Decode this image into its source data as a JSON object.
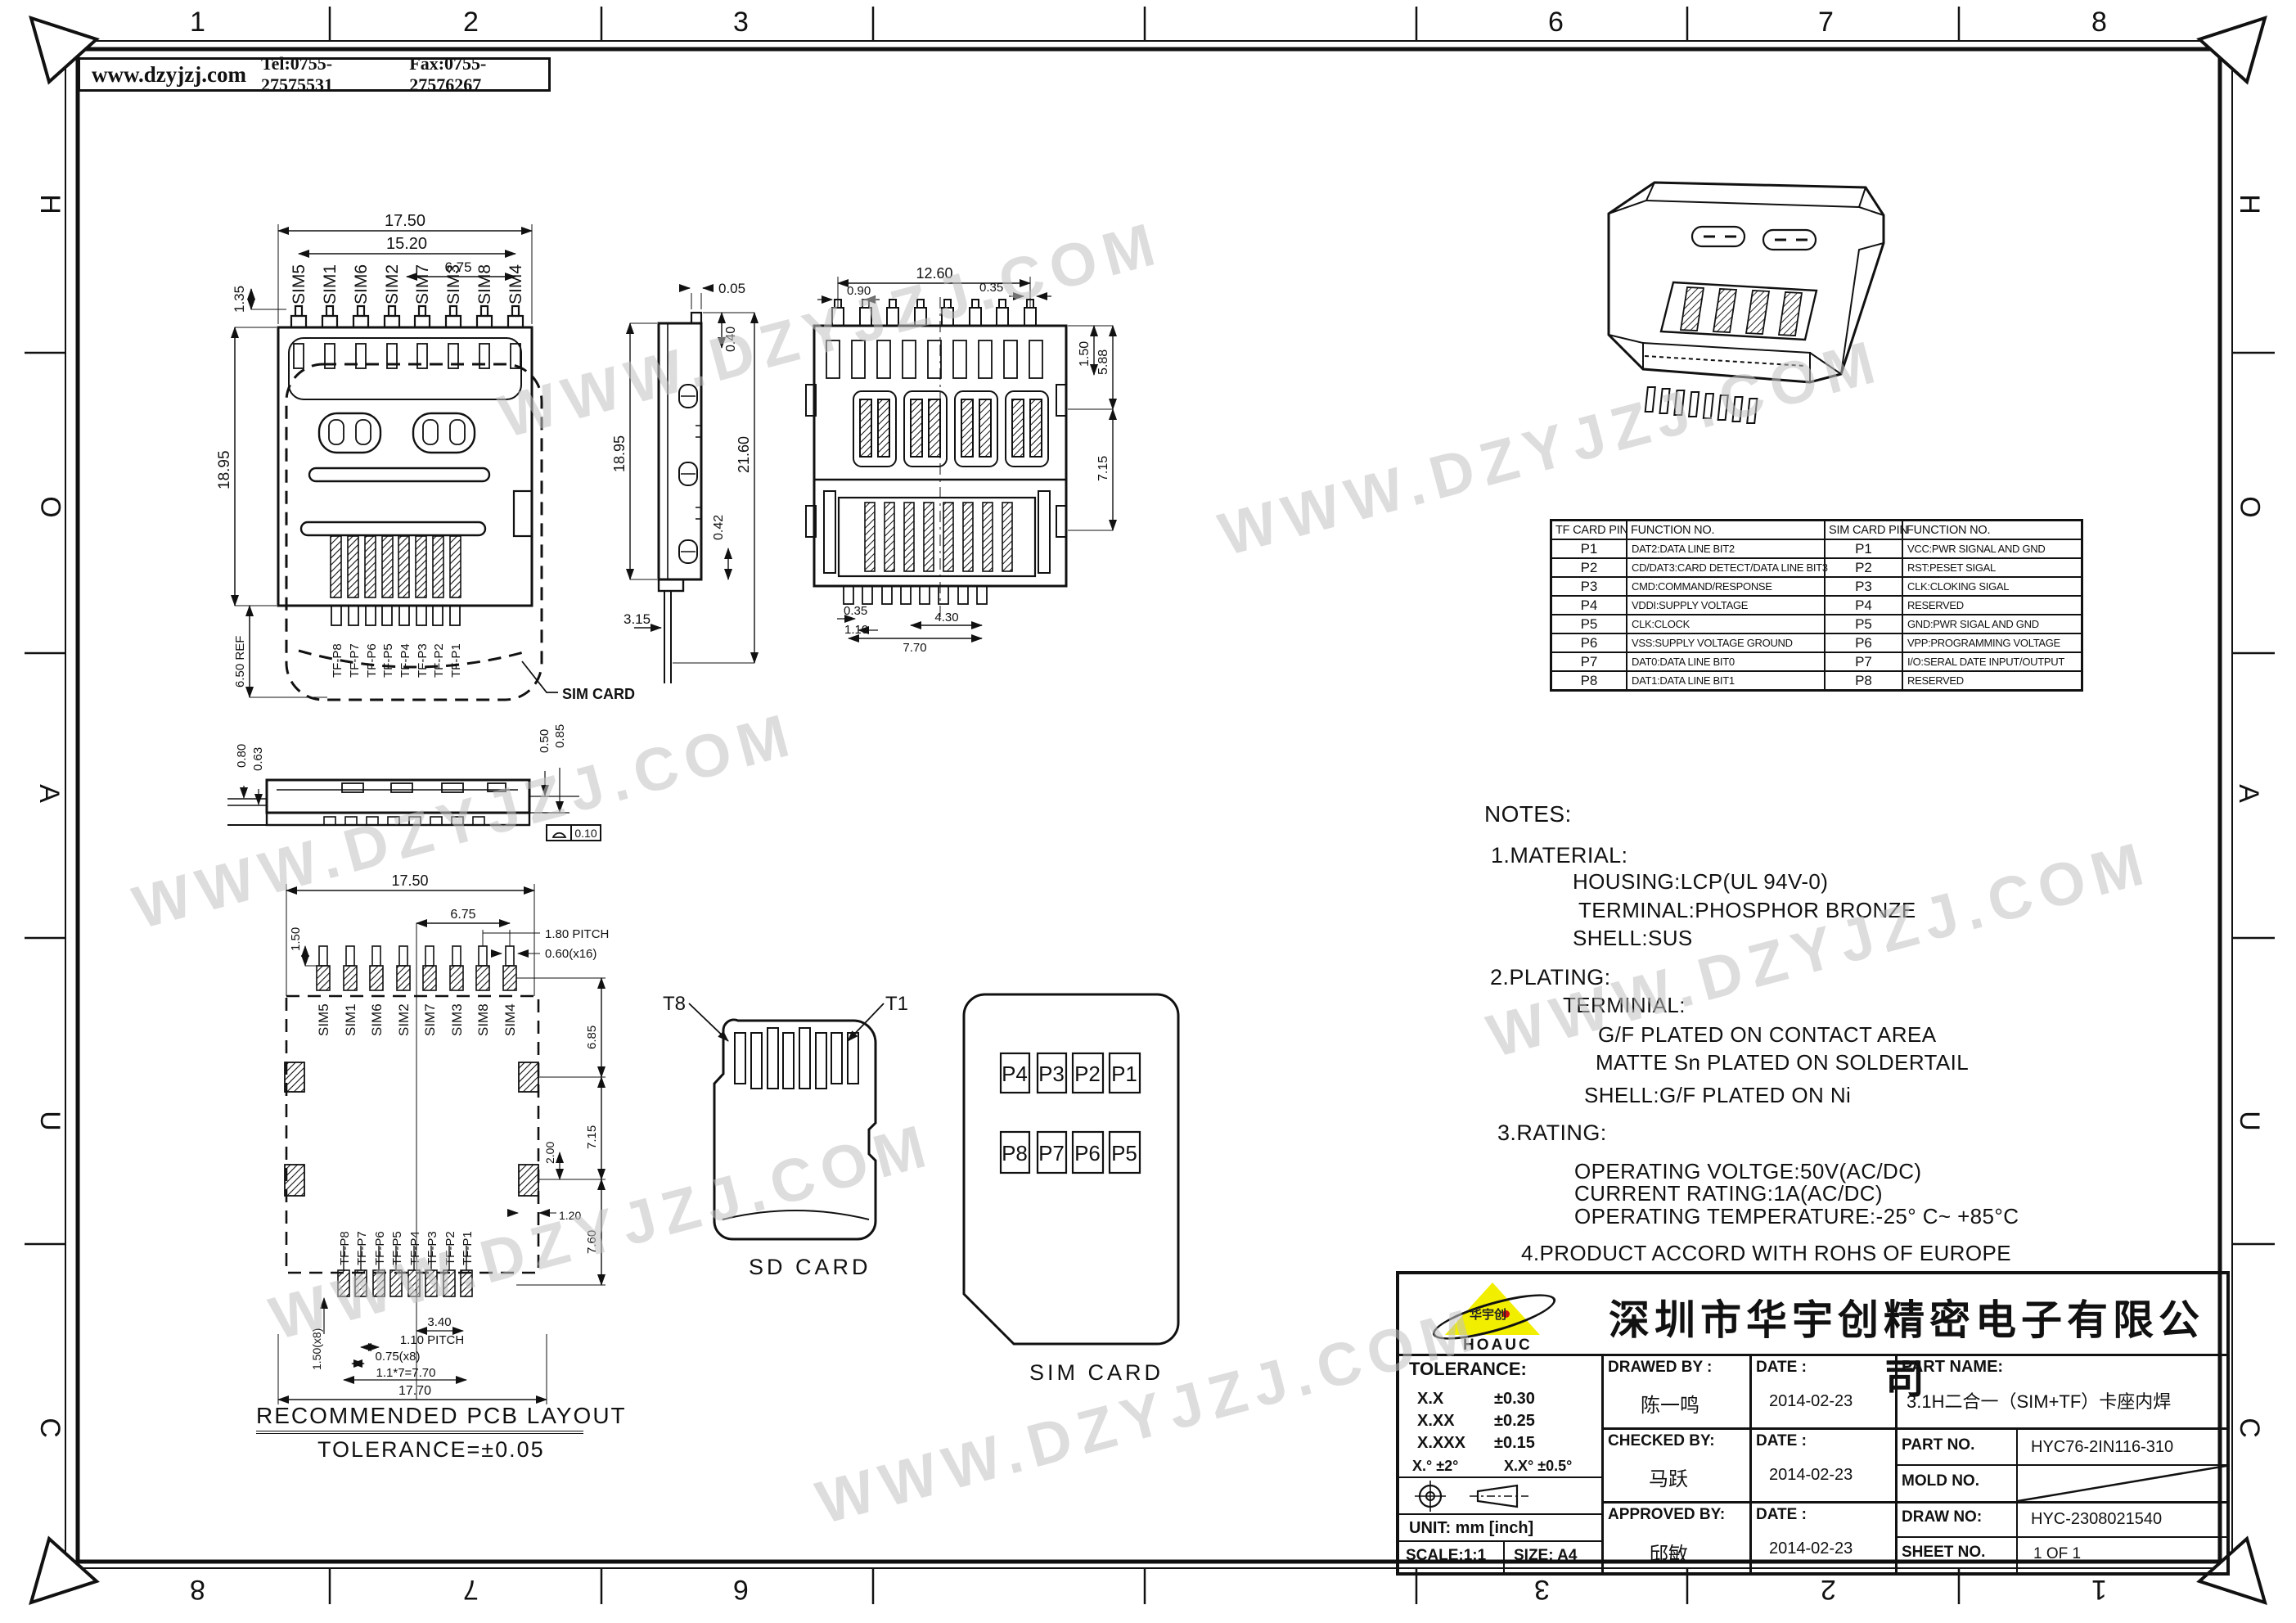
{
  "header": {
    "website": "www.dzyjzj.com",
    "tel": "Tel:0755-27575531",
    "fax": "Fax:0755-27576267"
  },
  "frame": {
    "top_numbers": [
      "1",
      "2",
      "3",
      "6",
      "7",
      "8"
    ],
    "bottom_numbers": [
      "8",
      "7",
      "6",
      "3",
      "2",
      "1"
    ],
    "left_letters": [
      "H",
      "O",
      "A",
      "U",
      "C"
    ],
    "right_letters": [
      "H",
      "O",
      "A",
      "U",
      "C"
    ]
  },
  "watermark": {
    "text": "WWW.DZYJZJ.COM",
    "color": "#c3c3c3"
  },
  "pins": {
    "sim": [
      "SIM5",
      "SIM1",
      "SIM6",
      "SIM2",
      "SIM7",
      "SIM3",
      "SIM8",
      "SIM4"
    ],
    "tf": [
      "TF-P8",
      "TF-P7",
      "TF-P6",
      "TF-P5",
      "TF-P4",
      "TF-P3",
      "TF-P2",
      "TF-P1"
    ]
  },
  "top_view": {
    "dims": {
      "w": "17.50",
      "pins_w": "15.20",
      "half_w": "6.75",
      "pin_h": "1.35",
      "h": "18.95",
      "ref": "6.50 REF"
    },
    "callout": "SIM CARD"
  },
  "side_view": {
    "dims": {
      "step": "0.05",
      "lip": "0.40",
      "h": "18.95",
      "total_h": "21.60",
      "foot": "0.42",
      "tail": "3.15"
    }
  },
  "front_view": {
    "dims": {
      "w": "12.60",
      "off": "0.90",
      "pin_w": "0.35",
      "lip": "1.50",
      "upper": "5.88",
      "lower": "7.15",
      "bpin": "0.35",
      "bpitch": "1.10",
      "bspan": "4.30",
      "btotal": "7.70"
    }
  },
  "profile_view": {
    "dims": {
      "h1": "0.80",
      "h2": "0.63",
      "h3": "0.50",
      "h4": "0.85"
    },
    "flatness": "0.10"
  },
  "pcb_view": {
    "dims": {
      "w": "17.50",
      "pad_h": "1.50",
      "half_w": "6.75",
      "pitch": "1.80  PITCH",
      "pad_w": "0.60(x16)",
      "side1": "6.85",
      "side2": "7.15",
      "tab": "2.00",
      "tab_w": "1.20",
      "side3": "7.60",
      "tf_pad_h": "1.50(x8)",
      "span": "3.40",
      "tf_pitch": "1.10  PITCH",
      "tf_pad_w": "0.75(x8)",
      "tf_span": "1.1*7=7.70",
      "total_w": "17.70"
    },
    "title": "RECOMMENDED PCB LAYOUT",
    "tolerance": "TOLERANCE=±0.05"
  },
  "sd_card": {
    "t8": "T8",
    "t1": "T1",
    "caption": "SD CARD"
  },
  "sim_card": {
    "pads": [
      "P4",
      "P3",
      "P2",
      "P1",
      "P8",
      "P7",
      "P6",
      "P5"
    ],
    "caption": "SIM CARD"
  },
  "tf_table": {
    "headers": [
      "TF CARD PIN",
      "FUNCTION NO."
    ],
    "rows": [
      [
        "P1",
        "DAT2:DATA LINE BIT2"
      ],
      [
        "P2",
        "CD/DAT3:CARD DETECT/DATA LINE BIT3"
      ],
      [
        "P3",
        "CMD:COMMAND/RESPONSE"
      ],
      [
        "P4",
        "VDDI:SUPPLY VOLTAGE"
      ],
      [
        "P5",
        "CLK:CLOCK"
      ],
      [
        "P6",
        "VSS:SUPPLY VOLTAGE GROUND"
      ],
      [
        "P7",
        "DAT0:DATA LINE BIT0"
      ],
      [
        "P8",
        "DAT1:DATA LINE BIT1"
      ]
    ]
  },
  "sim_table": {
    "headers": [
      "SIM CARD PIN",
      "FUNCTION NO."
    ],
    "rows": [
      [
        "P1",
        "VCC:PWR SIGNAL AND GND"
      ],
      [
        "P2",
        "RST:PESET SIGAL"
      ],
      [
        "P3",
        "CLK:CLOKING SIGAL"
      ],
      [
        "P4",
        "RESERVED"
      ],
      [
        "P5",
        "GND:PWR SIGAL AND GND"
      ],
      [
        "P6",
        "VPP:PROGRAMMING VOLTAGE"
      ],
      [
        "P7",
        "I/O:SERAL DATE INPUT/OUTPUT"
      ],
      [
        "P8",
        "RESERVED"
      ]
    ]
  },
  "notes": {
    "lines": [
      "NOTES:",
      "1.MATERIAL:",
      "HOUSING:LCP(UL 94V-0)",
      "TERMINAL:PHOSPHOR BRONZE",
      "SHELL:SUS",
      "2.PLATING:",
      "TERMINIAL:",
      "G/F PLATED ON CONTACT AREA",
      "MATTE Sn PLATED ON SOLDERTAIL",
      "SHELL:G/F PLATED ON Ni",
      "3.RATING:",
      "OPERATING VOLTGE:50V(AC/DC)",
      "CURRENT RATING:1A(AC/DC)",
      "OPERATING TEMPERATURE:-25° C~ +85°C",
      "4.PRODUCT ACCORD WITH ROHS OF EUROPE"
    ]
  },
  "title_block": {
    "company": "深圳市华宇创精密电子有限公司",
    "logo_text": "华宇创",
    "logo_sub": "HOAUC",
    "logo_color": "#f2ee00",
    "tolerance": {
      "title": "TOLERANCE:",
      "rows": [
        [
          "X.X",
          "±0.30"
        ],
        [
          "X.XX",
          "±0.25"
        ],
        [
          "X.XXX",
          "±0.15"
        ]
      ],
      "angles": [
        "X.°  ±2°",
        "X.X°  ±0.5°"
      ]
    },
    "unit": "UNIT:  mm  [inch]",
    "scale": "SCALE:1:1",
    "size": "SIZE:  A4",
    "drawn": {
      "label": "DRAWED BY :",
      "name": "陈一鸣",
      "date_label": "DATE :",
      "date": "2014-02-23"
    },
    "checked": {
      "label": "CHECKED BY:",
      "name": "马跃",
      "date_label": "DATE :",
      "date": "2014-02-23"
    },
    "approved": {
      "label": "APPROVED BY:",
      "name": "邱敏",
      "date_label": "DATE :",
      "date": "2014-02-23"
    },
    "part_name": {
      "label": "PART NAME:",
      "value": "3.1H二合一（SIM+TF）卡座内焊"
    },
    "part_no": {
      "label": "PART NO.",
      "value": "HYC76-2IN116-310"
    },
    "mold_no": {
      "label": "MOLD NO.",
      "value": ""
    },
    "draw_no": {
      "label": "DRAW NO:",
      "value": "HYC-2308021540"
    },
    "sheet_no": {
      "label": "SHEET NO.",
      "value": "1 OF 1"
    }
  }
}
